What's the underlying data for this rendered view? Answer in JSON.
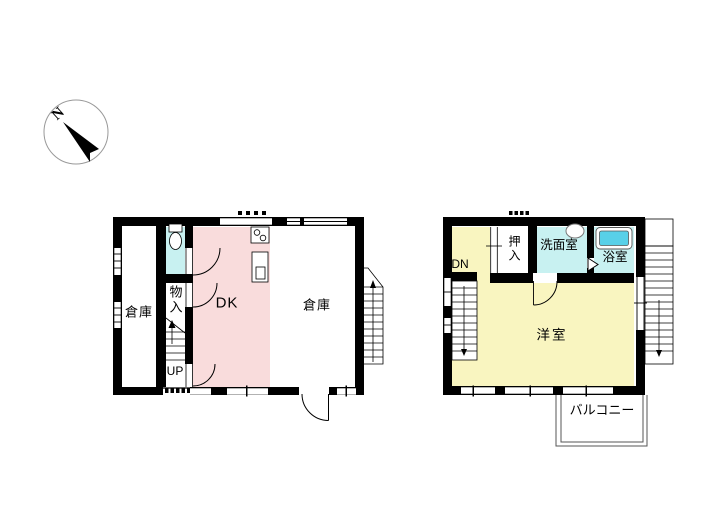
{
  "compass": {
    "north_label": "N"
  },
  "floor1": {
    "storage_left_label": "倉庫",
    "closet_label": "物入",
    "stairs_up_label": "UP",
    "dining_kitchen_label": "DK",
    "storage_right_label": "倉庫"
  },
  "floor2": {
    "stairs_down_label": "DN",
    "closet_label": "押入",
    "washroom_label": "洗面室",
    "bathroom_label": "浴室",
    "western_room_label": "洋室",
    "balcony_label": "バルコニー"
  },
  "colors": {
    "dining_kitchen": "#f9dcdc",
    "wet_area": "#c8f1f1",
    "bathtub": "#58d0e8",
    "western_room": "#f9f5c0",
    "wall": "#000000"
  }
}
